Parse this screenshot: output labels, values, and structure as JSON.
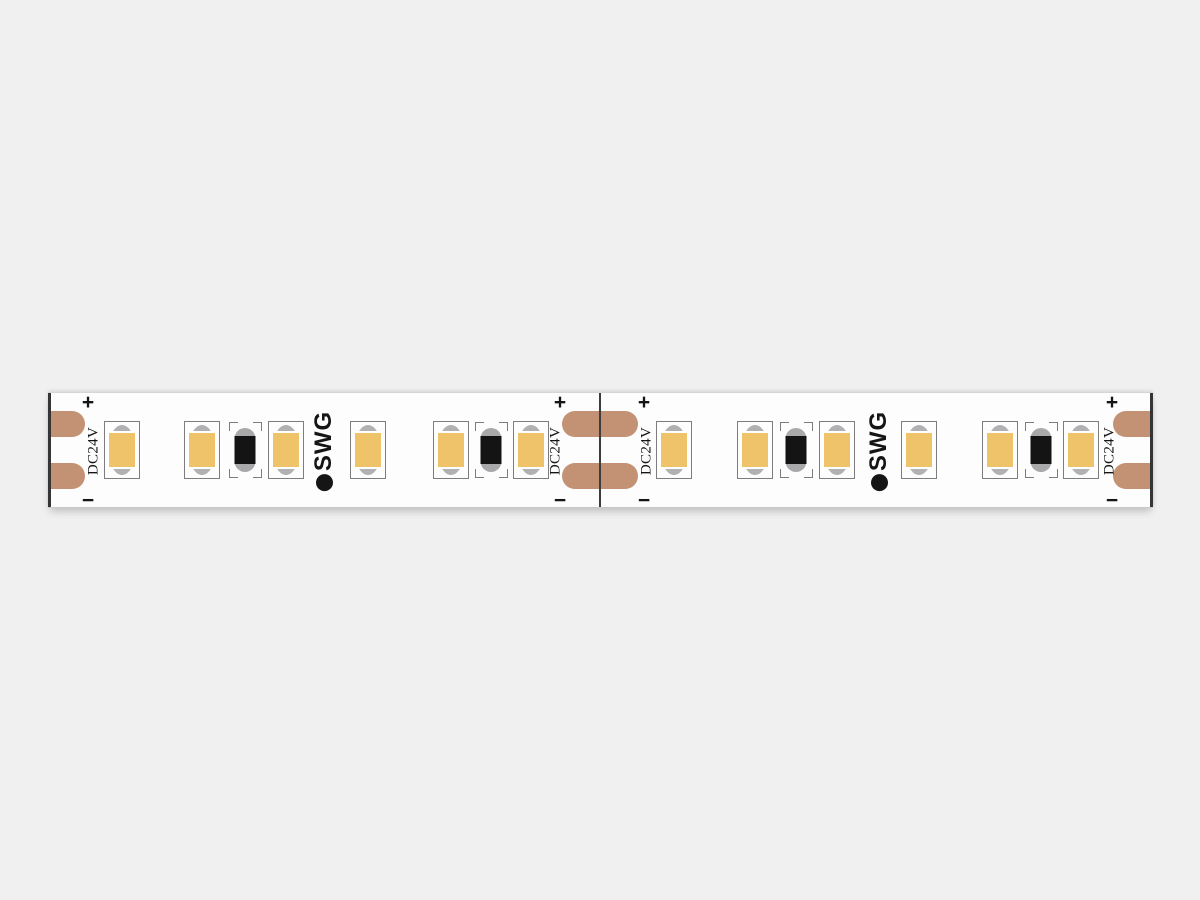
{
  "canvas": {
    "width": 1200,
    "height": 900,
    "background": "#f0f0f0"
  },
  "labels": {
    "plus": "+",
    "minus": "−",
    "voltage": "DC24V",
    "brand": "SWG"
  },
  "colors": {
    "strip_body": "#fdfdfd",
    "copper_pad": "#c39173",
    "led_yellow": "#efc369",
    "led_metal": "#b1b1b3",
    "resistor_body": "#a9a9ab",
    "resistor_black": "#141414",
    "component_outline": "#7d7d7d",
    "ink": "#151515",
    "cut_line": "#3c3c3c",
    "edge_line": "#353535"
  },
  "strip": {
    "x": 48,
    "y": 392,
    "width": 1105,
    "height": 116
  },
  "components": {
    "leds": {
      "centers_x": [
        122,
        202,
        286,
        368,
        451,
        531,
        674,
        755,
        837,
        919,
        1000,
        1081
      ],
      "top_y": 420,
      "width": 36,
      "height": 58
    },
    "resistors": {
      "centers_x": [
        245,
        491,
        796,
        1041
      ],
      "top_y": 421,
      "width": 33,
      "height": 56
    },
    "logos": {
      "centers_x": [
        324,
        879
      ],
      "center_y": 450
    },
    "pads": {
      "rows_y": [
        410,
        462
      ],
      "height": 26,
      "groups": [
        {
          "x": 48,
          "width": 37,
          "round_left": false,
          "round_right": true
        },
        {
          "x": 562,
          "width": 76,
          "round_left": true,
          "round_right": true
        },
        {
          "x": 1113,
          "width": 40,
          "round_left": true,
          "round_right": false
        }
      ]
    },
    "marks": {
      "columns": [
        {
          "x": 88,
          "voltage_x": 94
        },
        {
          "x": 560,
          "voltage_x": 556
        },
        {
          "x": 644,
          "voltage_x": 647
        },
        {
          "x": 1112,
          "voltage_x": 1110
        }
      ],
      "plus_y": 401,
      "minus_y": 499,
      "voltage_y": 450
    },
    "cut_lines_x": [
      600
    ],
    "edge_lines_x": [
      48,
      1153
    ]
  }
}
